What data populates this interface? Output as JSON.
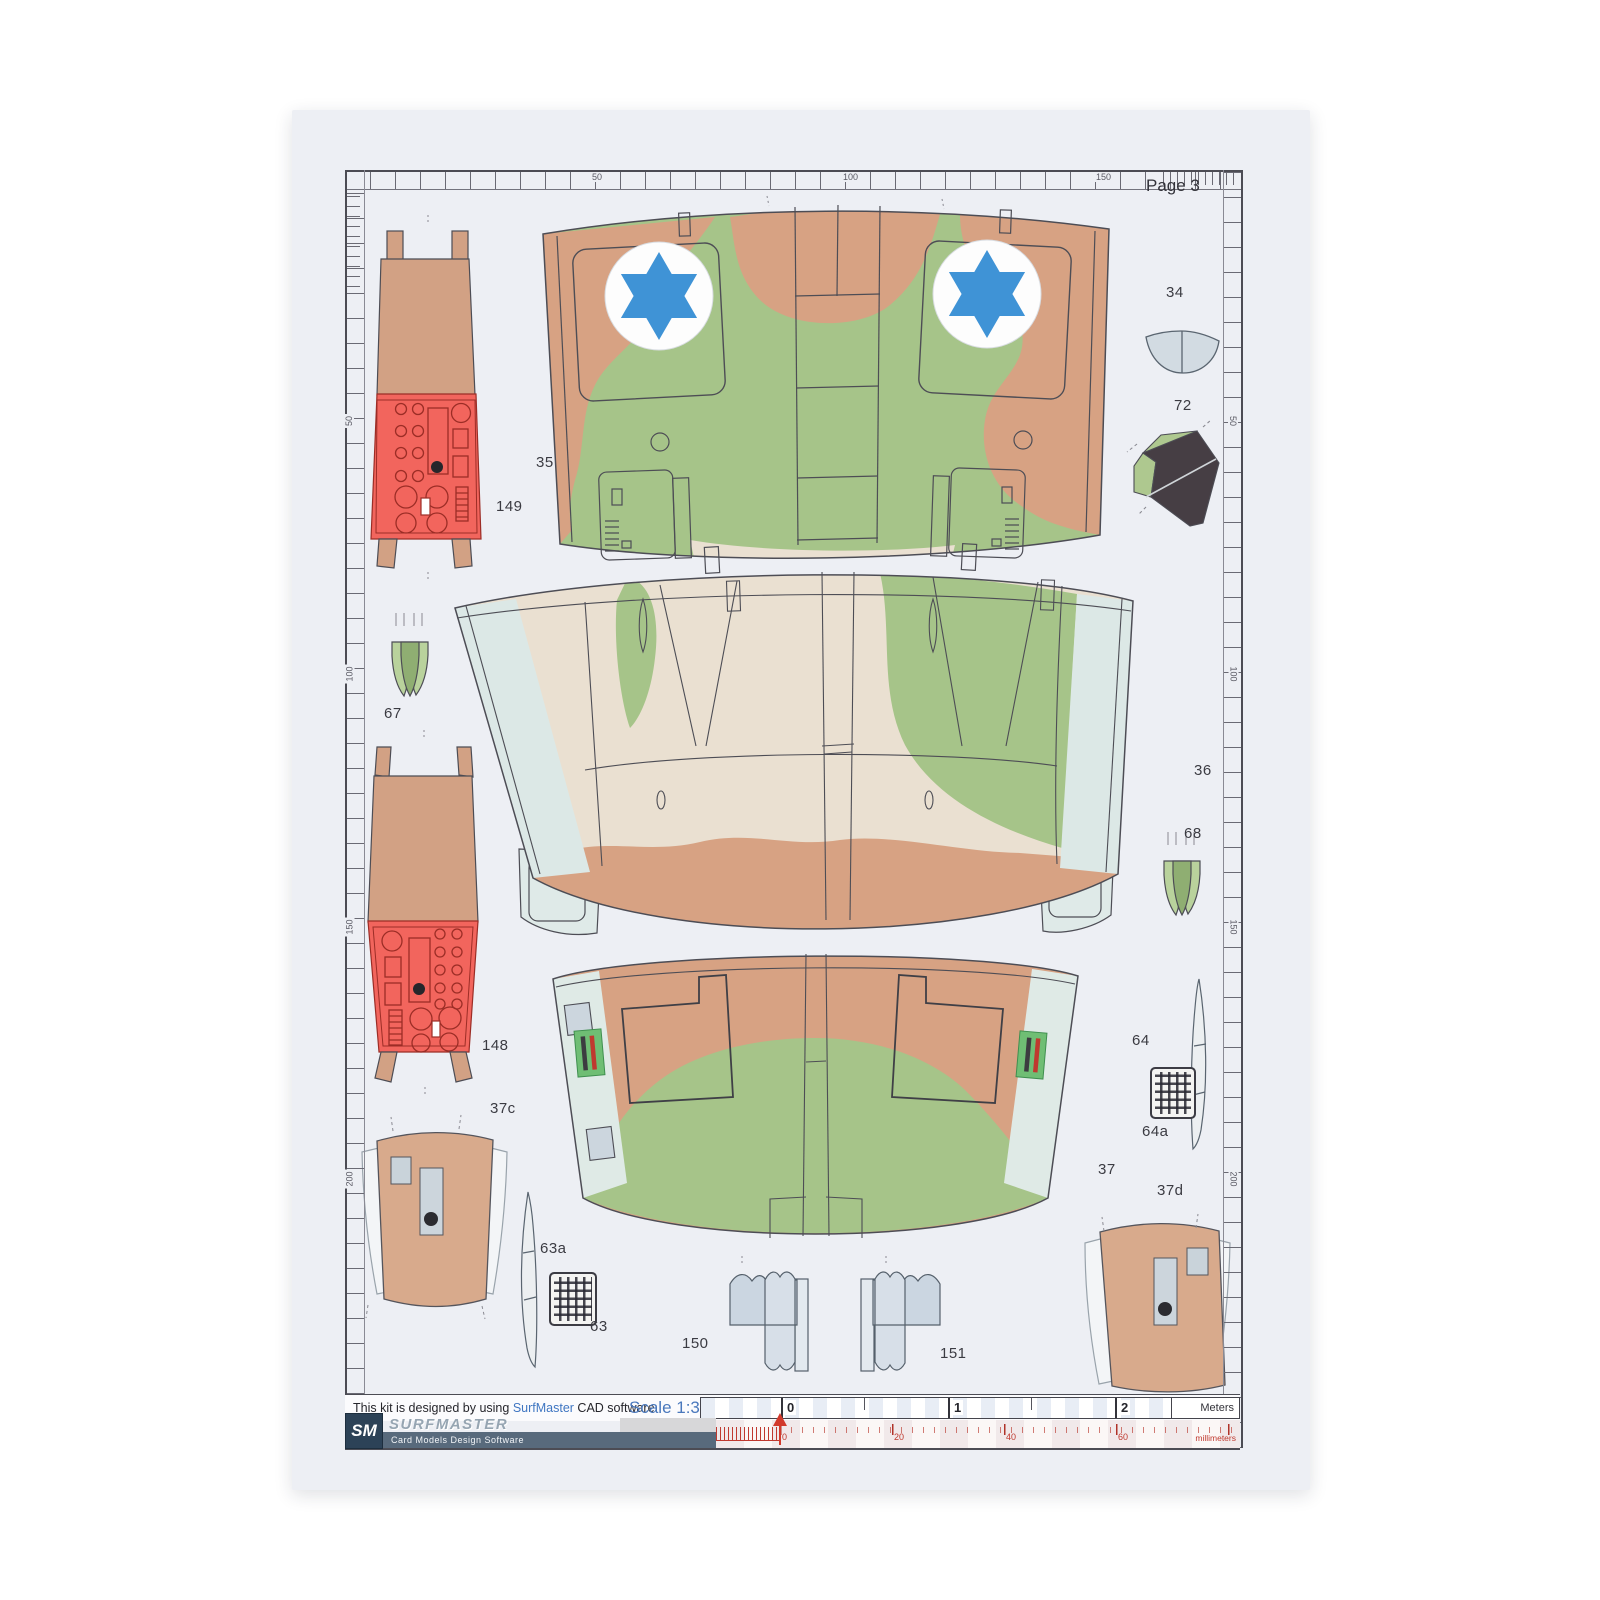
{
  "page": {
    "label": "Page 3"
  },
  "rulers": {
    "top": [
      "50",
      "100",
      "150"
    ],
    "left": [
      "50",
      "100",
      "150",
      "200"
    ],
    "right": [
      "50",
      "100",
      "150",
      "200"
    ]
  },
  "parts": {
    "p34": "34",
    "p35": "35",
    "p36": "36",
    "p37": "37",
    "p37c": "37c",
    "p37d": "37d",
    "p63": "63",
    "p63a": "63a",
    "p64": "64",
    "p64a": "64a",
    "p67": "67",
    "p68": "68",
    "p72": "72",
    "p148": "148",
    "p149": "149",
    "p150": "150",
    "p151": "151"
  },
  "footer": {
    "kit_text_prefix": "This kit is designed by using ",
    "kit_text_brand": "SurfMaster",
    "kit_text_suffix": " CAD software",
    "scale_label": "Scale 1:32",
    "logo_initials": "SM",
    "logo_name": "SURFMASTER",
    "logo_subtitle": "Card Models Design Software",
    "meter_scale": {
      "ticks": [
        "0",
        "1",
        "2"
      ],
      "unit": "Meters"
    },
    "mm_scale": {
      "ticks": [
        "0",
        "20",
        "40",
        "60"
      ],
      "unit": "millimeters"
    }
  },
  "colors": {
    "camo_green": "#a6c489",
    "camo_tan": "#d7a283",
    "camo_cream": "#eae0d1",
    "panel_blue_gray": "#dde9e7",
    "cockpit_red": "#f2655d",
    "star_blue": "#3f93d6",
    "accent_blue": "#4a78bc",
    "ruler_red": "#c0392f"
  }
}
